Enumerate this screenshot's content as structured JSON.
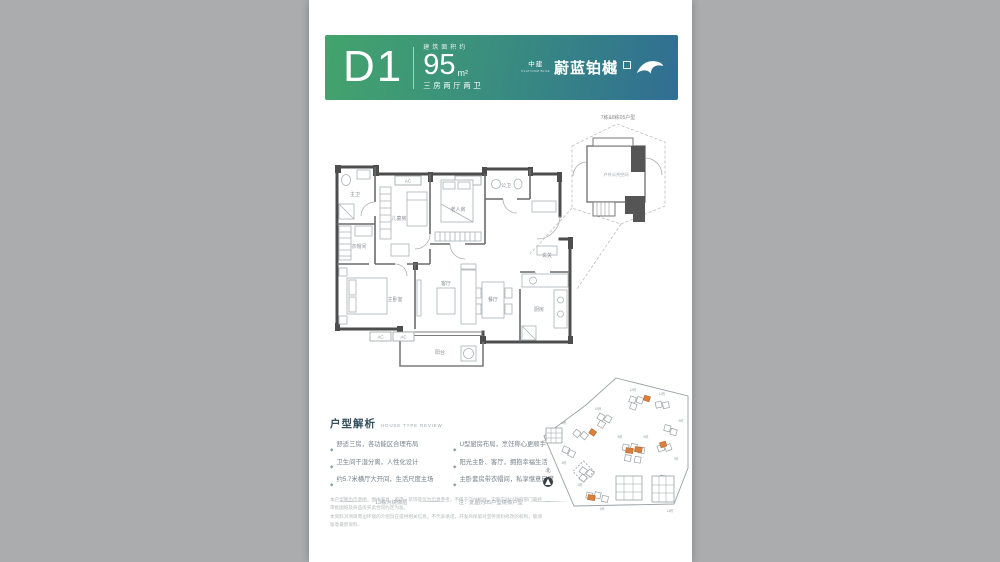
{
  "page": {
    "bg": "#aaacae",
    "paper": "#ffffff"
  },
  "banner": {
    "unit_code": "D1",
    "area_label": "建筑面积约",
    "area_value": "95",
    "area_unit": "m²",
    "layout_desc": "三房两厅两卫",
    "brand_prefix": "中建",
    "brand_latin": "PLATINUM BLUE",
    "brand_name": "蔚蓝铂樾",
    "colors": {
      "gradient_from": "#43a46c",
      "gradient_mid": "#3a8f7e",
      "gradient_to": "#306e93"
    }
  },
  "callout": {
    "title": "7栋&8栋05户型",
    "label": "户外公共空间"
  },
  "floorplan": {
    "rooms": {
      "master_bath": "主卫",
      "cloakroom": "衣帽间",
      "kids_room": "儿童房",
      "elder_room": "老人房",
      "public_bath": "公卫",
      "foyer": "玄关",
      "kitchen": "厨房",
      "dining": "餐厅",
      "living": "客厅",
      "master_bedroom": "主卧室",
      "balcony": "阳台",
      "ac": "AC"
    }
  },
  "analysis": {
    "title": "户型解析",
    "subtitle": "HOUSE TYPE REVIEW",
    "bullet_char": "◆",
    "bullets_left": [
      "舒适三房，各功能区合理布局",
      "卫生间干湿分离，人性化设计",
      "约5.7米横厅大开间，生活尺度主场"
    ],
    "bullets_right": [
      "U型厨房布局，烹饪称心更顺手",
      "阳光主卧、客厅，拥抱幸福生活",
      "主卧套房带衣帽间，私享惬意尺度"
    ],
    "note_left": "13栋为镜像层",
    "note_right": "注：此图为05户型镜像户型"
  },
  "siteplan": {
    "north_label": "北",
    "highlight_color": "#d9803f",
    "labels": [
      "12栋",
      "11栋",
      "10栋",
      "9栋",
      "8栋",
      "7栋",
      "6栋",
      "5栋",
      "3栋",
      "2栋",
      "1栋",
      "13栋"
    ]
  },
  "disclaimer": {
    "line1": "本户型图为示意图，图中家具、家电、装饰等仅为示意参考，不属于交付标准，实际交付以政府部门最终审批图纸及商品房买卖合同约定为准。",
    "line2": "本资料对项目周边环境的介绍旨在提供相关信息，不代表承诺，开发商保留对宣传资料修改的权利，敬请留意最新资料。"
  }
}
